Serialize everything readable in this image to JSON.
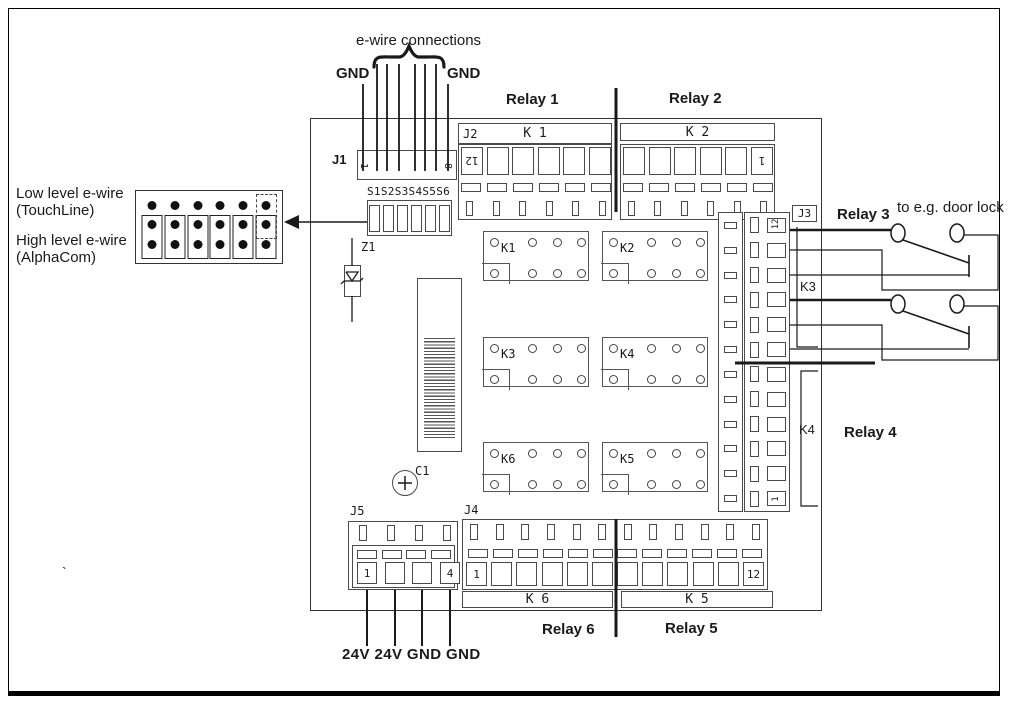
{
  "legend": {
    "low_line1": "Low level e-wire",
    "low_line2": "(TouchLine)",
    "high_line1": "High level e-wire",
    "high_line2": "(AlphaCom)"
  },
  "top_area": {
    "brace_label": "e-wire connections",
    "gnd_left": "GND",
    "gnd_right": "GND"
  },
  "sections": {
    "relay1": "Relay 1",
    "relay2": "Relay 2",
    "relay3": "Relay 3",
    "relay4": "Relay 4",
    "relay5": "Relay 5",
    "relay6": "Relay 6"
  },
  "connectors": {
    "j1": {
      "label": "J1",
      "pin_first": "1",
      "pin_last": "8"
    },
    "s_block": {
      "label": "S1S2S3S4S5S6"
    },
    "j2": {
      "label": "J2",
      "k1_bar": "K 1",
      "k2_bar": "K 2",
      "pin_first": "12",
      "pin_last": "1"
    },
    "j3": {
      "label": "J3",
      "k3_label": "K3",
      "k4_label": "K4",
      "pin_first": "12",
      "pin_last": "1"
    },
    "j4": {
      "label": "J4",
      "k6_bar": "K 6",
      "k5_bar": "K 5",
      "pin_first": "1",
      "pin_last": "12"
    },
    "j5": {
      "label": "J5",
      "pin_first": "1",
      "pin_last": "4"
    }
  },
  "power": {
    "labels": "24V 24V GND GND"
  },
  "components": {
    "z1": "Z1",
    "c1": "C1",
    "relay_ics": [
      "K1",
      "K2",
      "K3",
      "K4",
      "K6",
      "K5"
    ]
  },
  "annotations": {
    "door_lock": "to e.g. door lock",
    "stray_mark": "`"
  }
}
